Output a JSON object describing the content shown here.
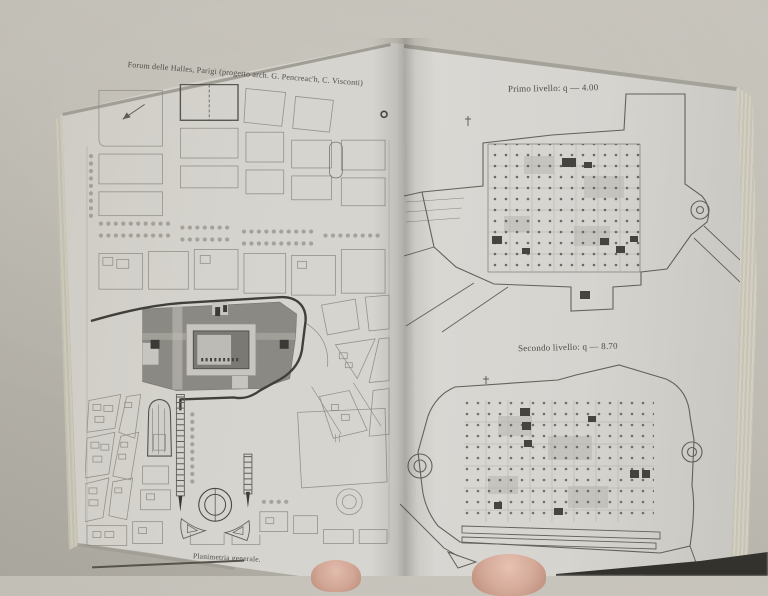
{
  "photo": {
    "background_hex": "#bfbcb3",
    "page_hex": "#d7d5d0",
    "ink_hex": "#55534d",
    "dark_building_hex": "#85837d",
    "finger_hex": "#d3a897",
    "book": {
      "left_page": {
        "title": "Forum delle Halles, Parigi (progetto arch. G. Pencreac'h, C. Visconti)",
        "caption": "Planimetria generale."
      },
      "right_page": {
        "plan_labels": [
          "Primo livello: q — 4.00",
          "Secondo livello: q — 8.70"
        ]
      }
    }
  }
}
